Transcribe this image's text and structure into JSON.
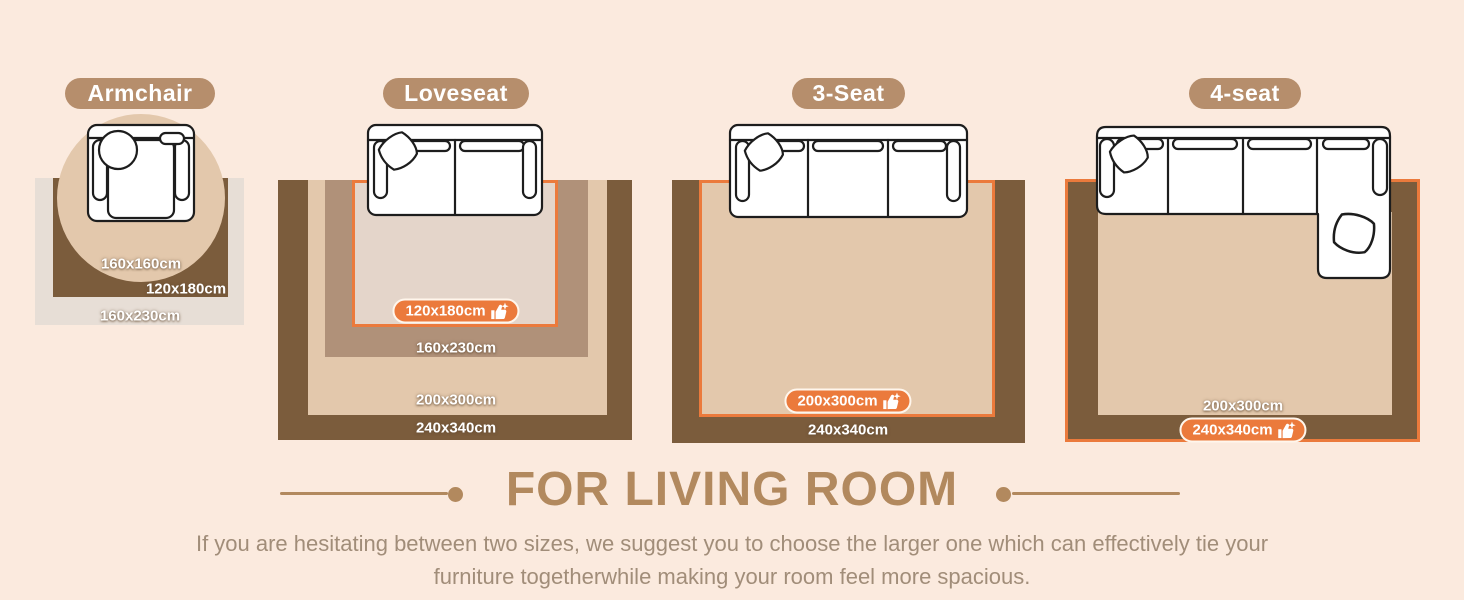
{
  "theme": {
    "bg": "#FBEADE",
    "orange": "#EB7A3C",
    "brown": "#7B5C3C",
    "tan": "#E3C8AC",
    "taupe": "#B09179",
    "rug_light": "#E4D5CA",
    "rug_gray": "#E7DED6",
    "pill": "#B68E6C",
    "heading": "#B2895E",
    "text": "#A18D79"
  },
  "icons": {
    "badge_icon": "thumbs-up-with-sparkle"
  },
  "sections": [
    {
      "title": "Armchair",
      "labels": [
        "160x160cm",
        "120x180cm",
        "160x230cm"
      ]
    },
    {
      "title": "Loveseat",
      "badge": "120x180cm",
      "labels": [
        "160x230cm",
        "200x300cm",
        "240x340cm"
      ]
    },
    {
      "title": "3-Seat",
      "badge": "200x300cm",
      "labels": [
        "240x340cm"
      ]
    },
    {
      "title": "4-seat",
      "badge": "240x340cm",
      "labels": [
        "200x300cm"
      ]
    }
  ],
  "footer": {
    "heading": "FOR LIVING ROOM",
    "line1": "If you are hesitating between two sizes, we suggest you to choose the larger one which can effectively tie your",
    "line2": "furniture togetherwhile making your room feel more spacious."
  }
}
